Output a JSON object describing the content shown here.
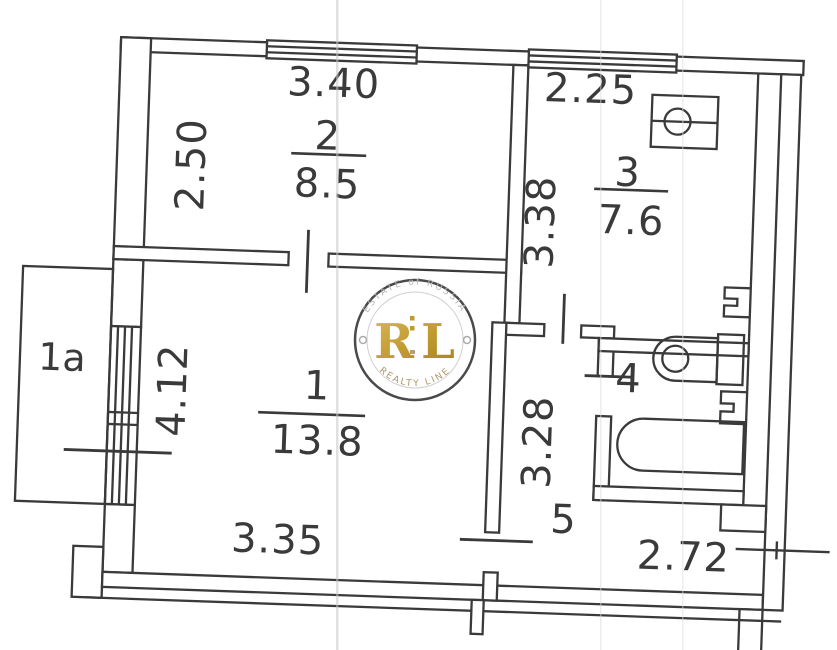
{
  "plan": {
    "rooms": [
      {
        "number": "1",
        "area": "13.8",
        "dim_width": "3.35",
        "dim_height": "4.12"
      },
      {
        "number": "2",
        "area": "8.5",
        "dim_width": "3.40",
        "dim_height": "2.50"
      },
      {
        "number": "3",
        "area": "7.6",
        "dim_width": "2.25",
        "dim_height": "3.38"
      },
      {
        "number": "4"
      },
      {
        "number": "5",
        "dim_width": "2.72",
        "dim_height": "3.28"
      },
      {
        "number": "1a"
      }
    ],
    "fixtures": [
      "bathtub-icon",
      "toilet-icon",
      "kitchen-sink-icon",
      "radiator-icon",
      "window-icon",
      "door-opening-mark"
    ]
  },
  "watermark": {
    "arc_top": "ESTATE of RUSSIA",
    "monogram": "RL",
    "arc_bottom": "REALTY LINE",
    "gold": "#c19a2f",
    "text_gray": "#b6b6b6"
  },
  "colors": {
    "ink": "#3a3a3a",
    "paper": "#ffffff",
    "scan_line": "#c6c6c6"
  }
}
